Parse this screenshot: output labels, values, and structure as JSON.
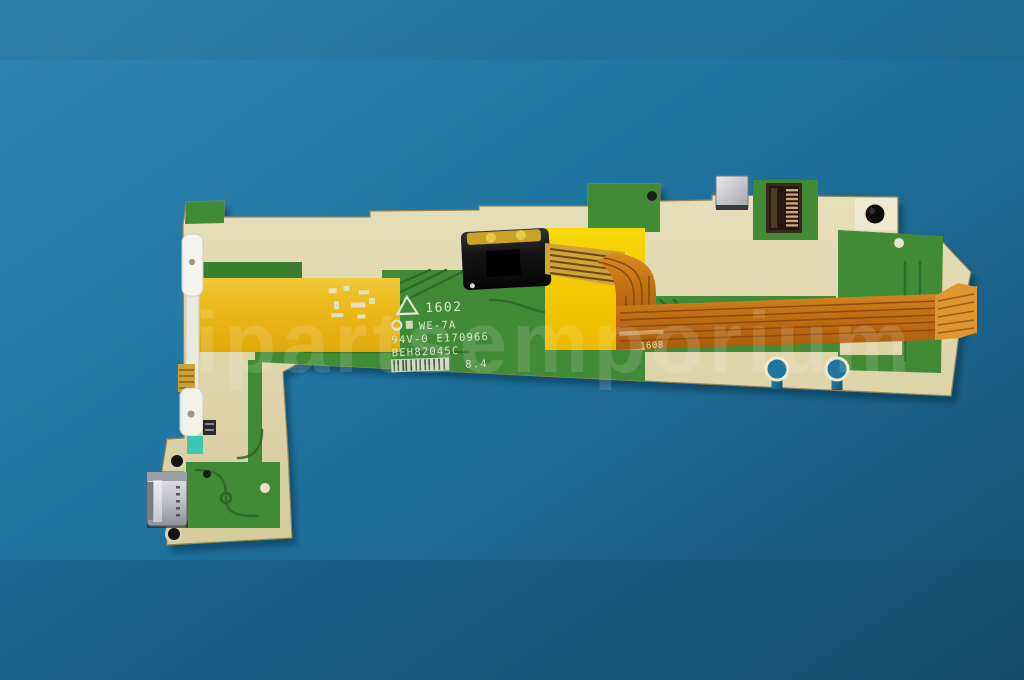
{
  "watermark": "ipartsemporium",
  "board_silkscreen": {
    "date_code": "1602",
    "material_grade": "WE-7A",
    "ul_rating": "94V-0 E170966",
    "part_number": "BEH82045C",
    "rev_mark": "8.4"
  },
  "flex_silkscreen": {
    "lot_mark": "1608"
  },
  "colors": {
    "bg1": "#2b81ad",
    "bg2": "#1f74a0",
    "bg3": "#19577b",
    "beige": "#ddd4a6",
    "beige-light": "#ece5c2",
    "green": "#428b36",
    "green2": "#3a7e30",
    "green-dark": "#2d6627",
    "kapton1": "#f0c93c",
    "kapton2": "#e3ab0c",
    "kapton3": "#f7d406",
    "flex": "#c4770f",
    "flex-dark": "#8a4a10",
    "teal": "#3ec6ae",
    "gold": "#c9a227"
  }
}
